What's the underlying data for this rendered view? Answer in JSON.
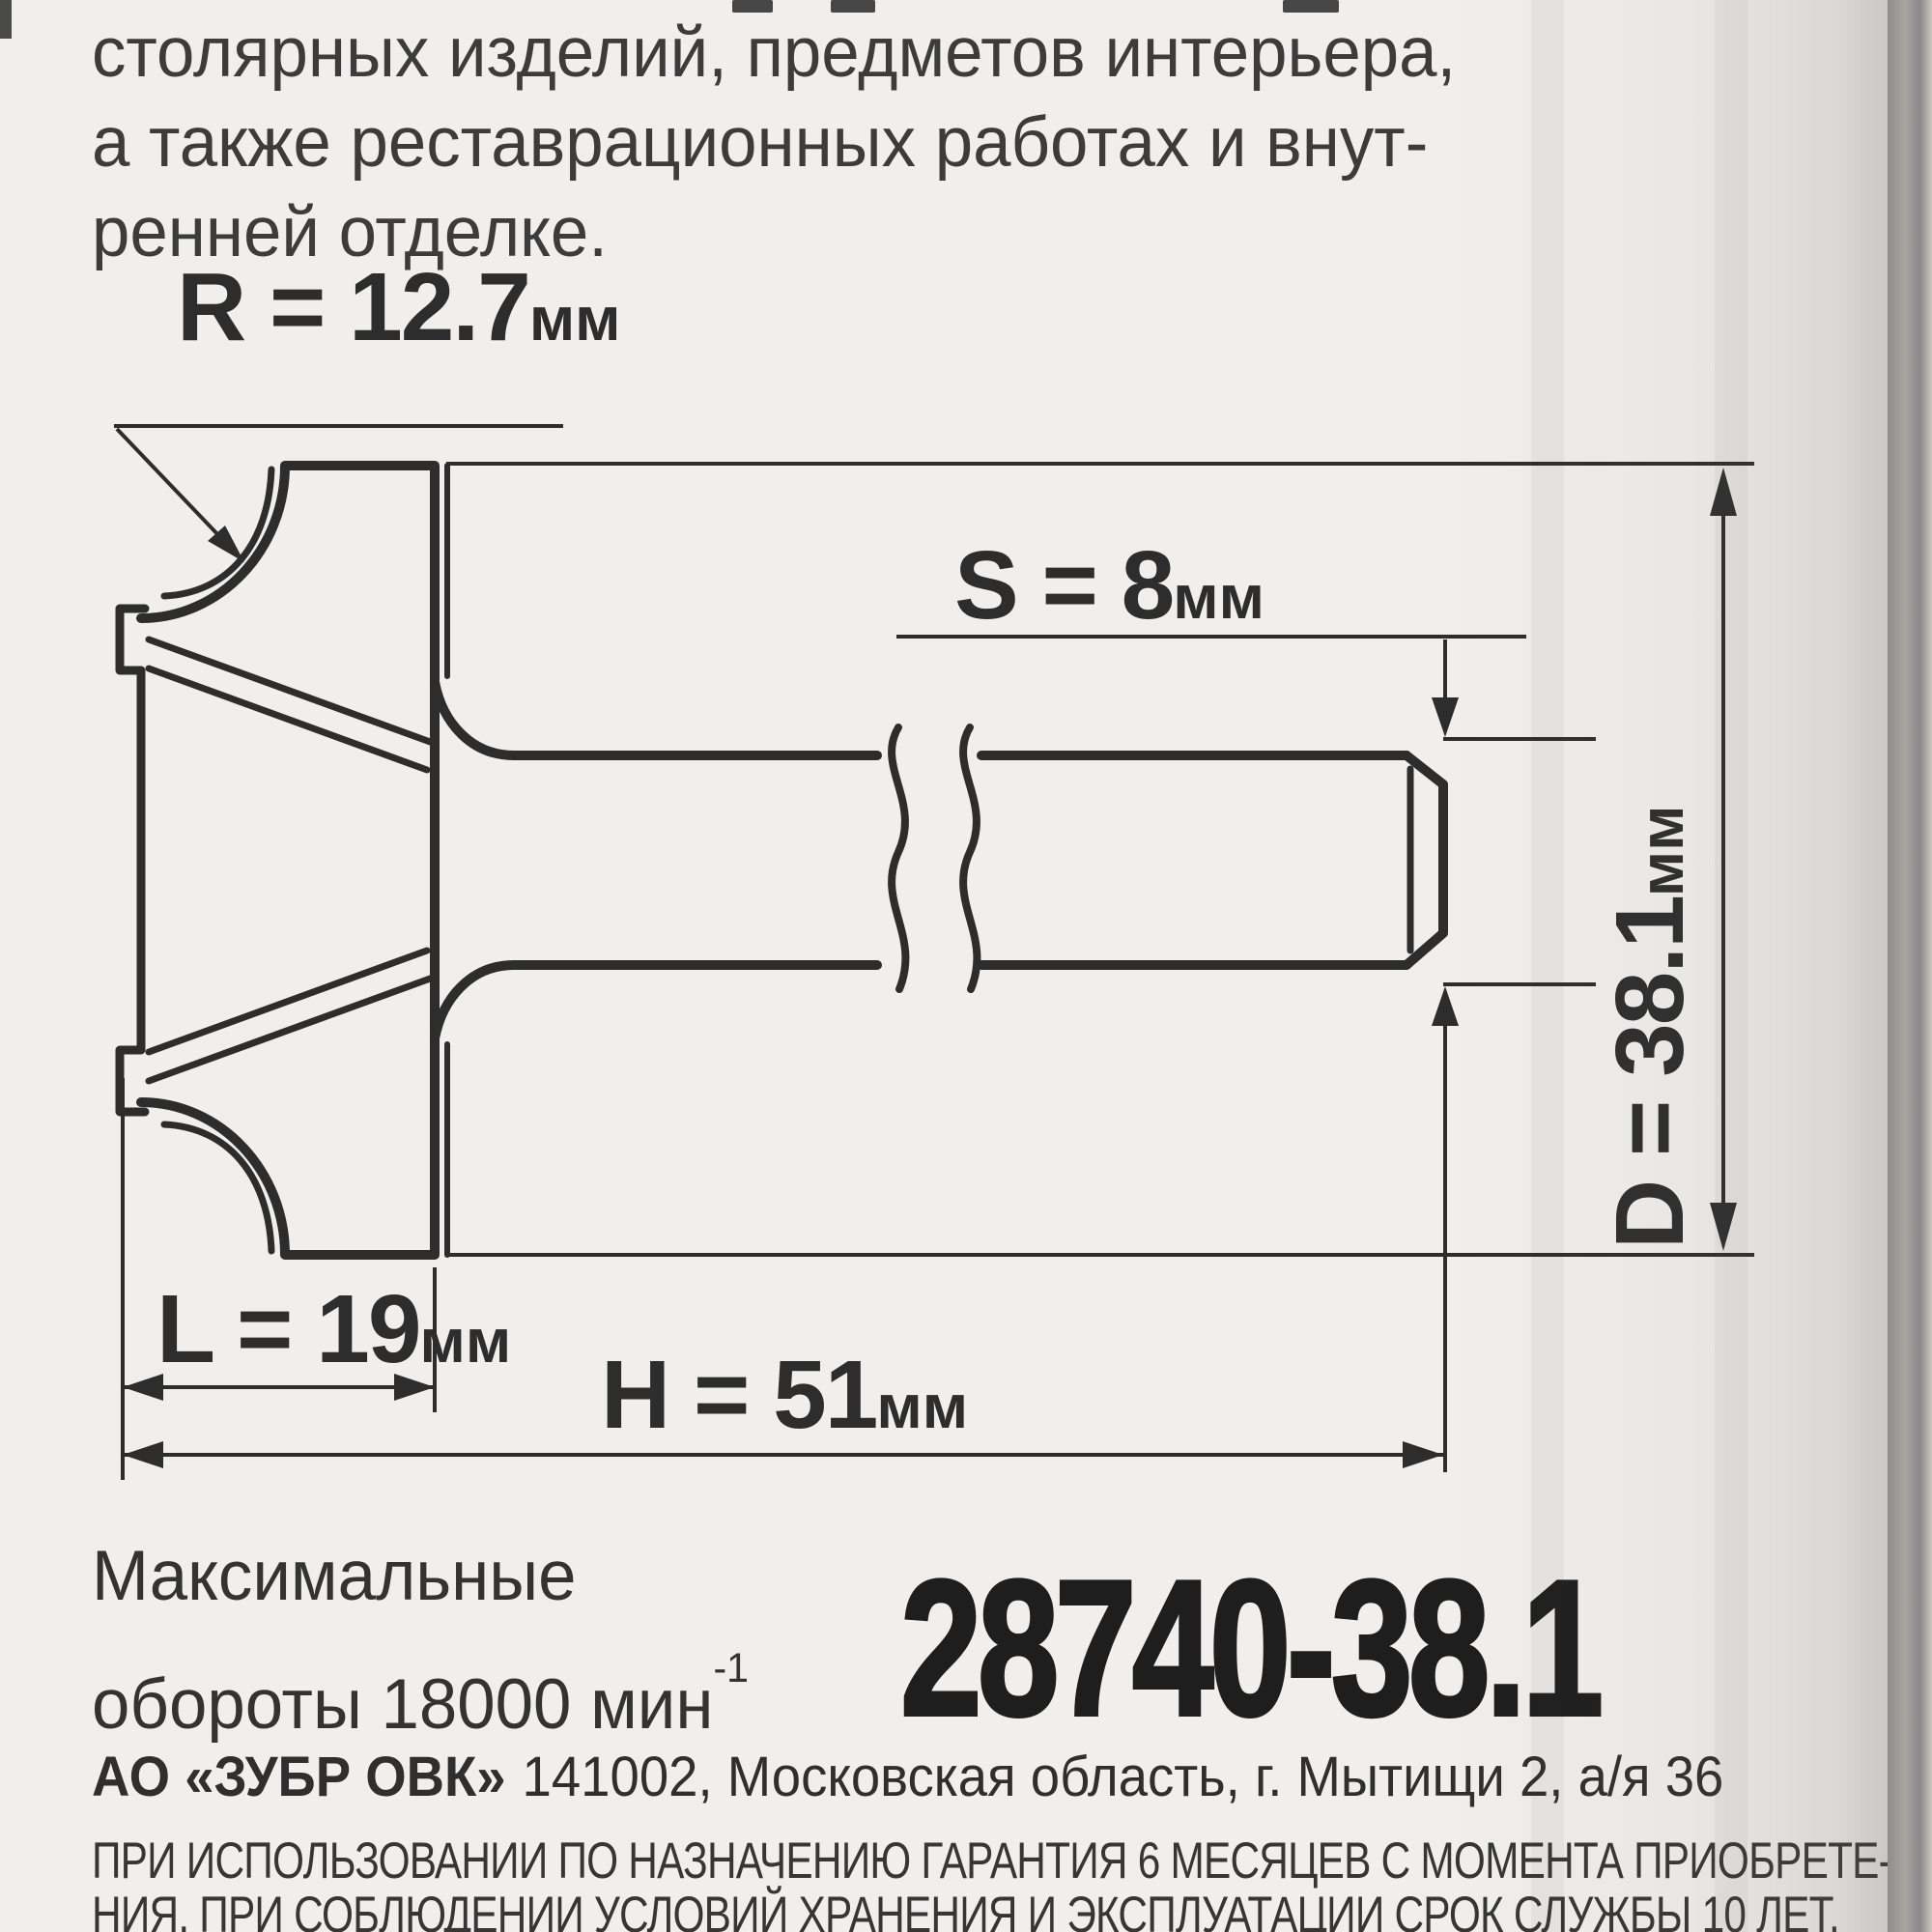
{
  "colors": {
    "paper": "#f0efed",
    "ink": "#2d2d2d",
    "edge_band": "#9e9d9a",
    "article_ink": "#1e1e1e"
  },
  "intro": {
    "lines": [
      "столярных изделий, предметов интерьера,",
      "а также реставрационных работах и внут-",
      "ренней отделке."
    ]
  },
  "dims": {
    "r_main": "R = 12.7",
    "r_unit": "мм",
    "s_main": "S = 8",
    "s_unit": "мм",
    "d_main": "D = 38.1",
    "d_unit": "мм",
    "l_main": "L = 19",
    "l_unit": "мм",
    "h_main": "H = 51",
    "h_unit": "мм"
  },
  "specs": {
    "rpm_line1": "Максимальные",
    "rpm_line2": "обороты 18000 мин",
    "rpm_sup": "-1",
    "article": "28740-38.1"
  },
  "footer": {
    "company": "АО «ЗУБР ОВК»",
    "address": "141002, Московская область, г. Мытищи 2, а/я 36",
    "legal_line1": "ПРИ ИСПОЛЬЗОВАНИИ ПО НАЗНАЧЕНИЮ ГАРАНТИЯ 6 МЕСЯЦЕВ С МОМЕНТА ПРИОБРЕТЕ-",
    "legal_line2": "НИЯ. ПРИ СОБЛЮДЕНИИ УСЛОВИЙ ХРАНЕНИЯ И ЭКСПЛУАТАЦИИ СРОК СЛУЖБЫ 10 ЛЕТ."
  }
}
